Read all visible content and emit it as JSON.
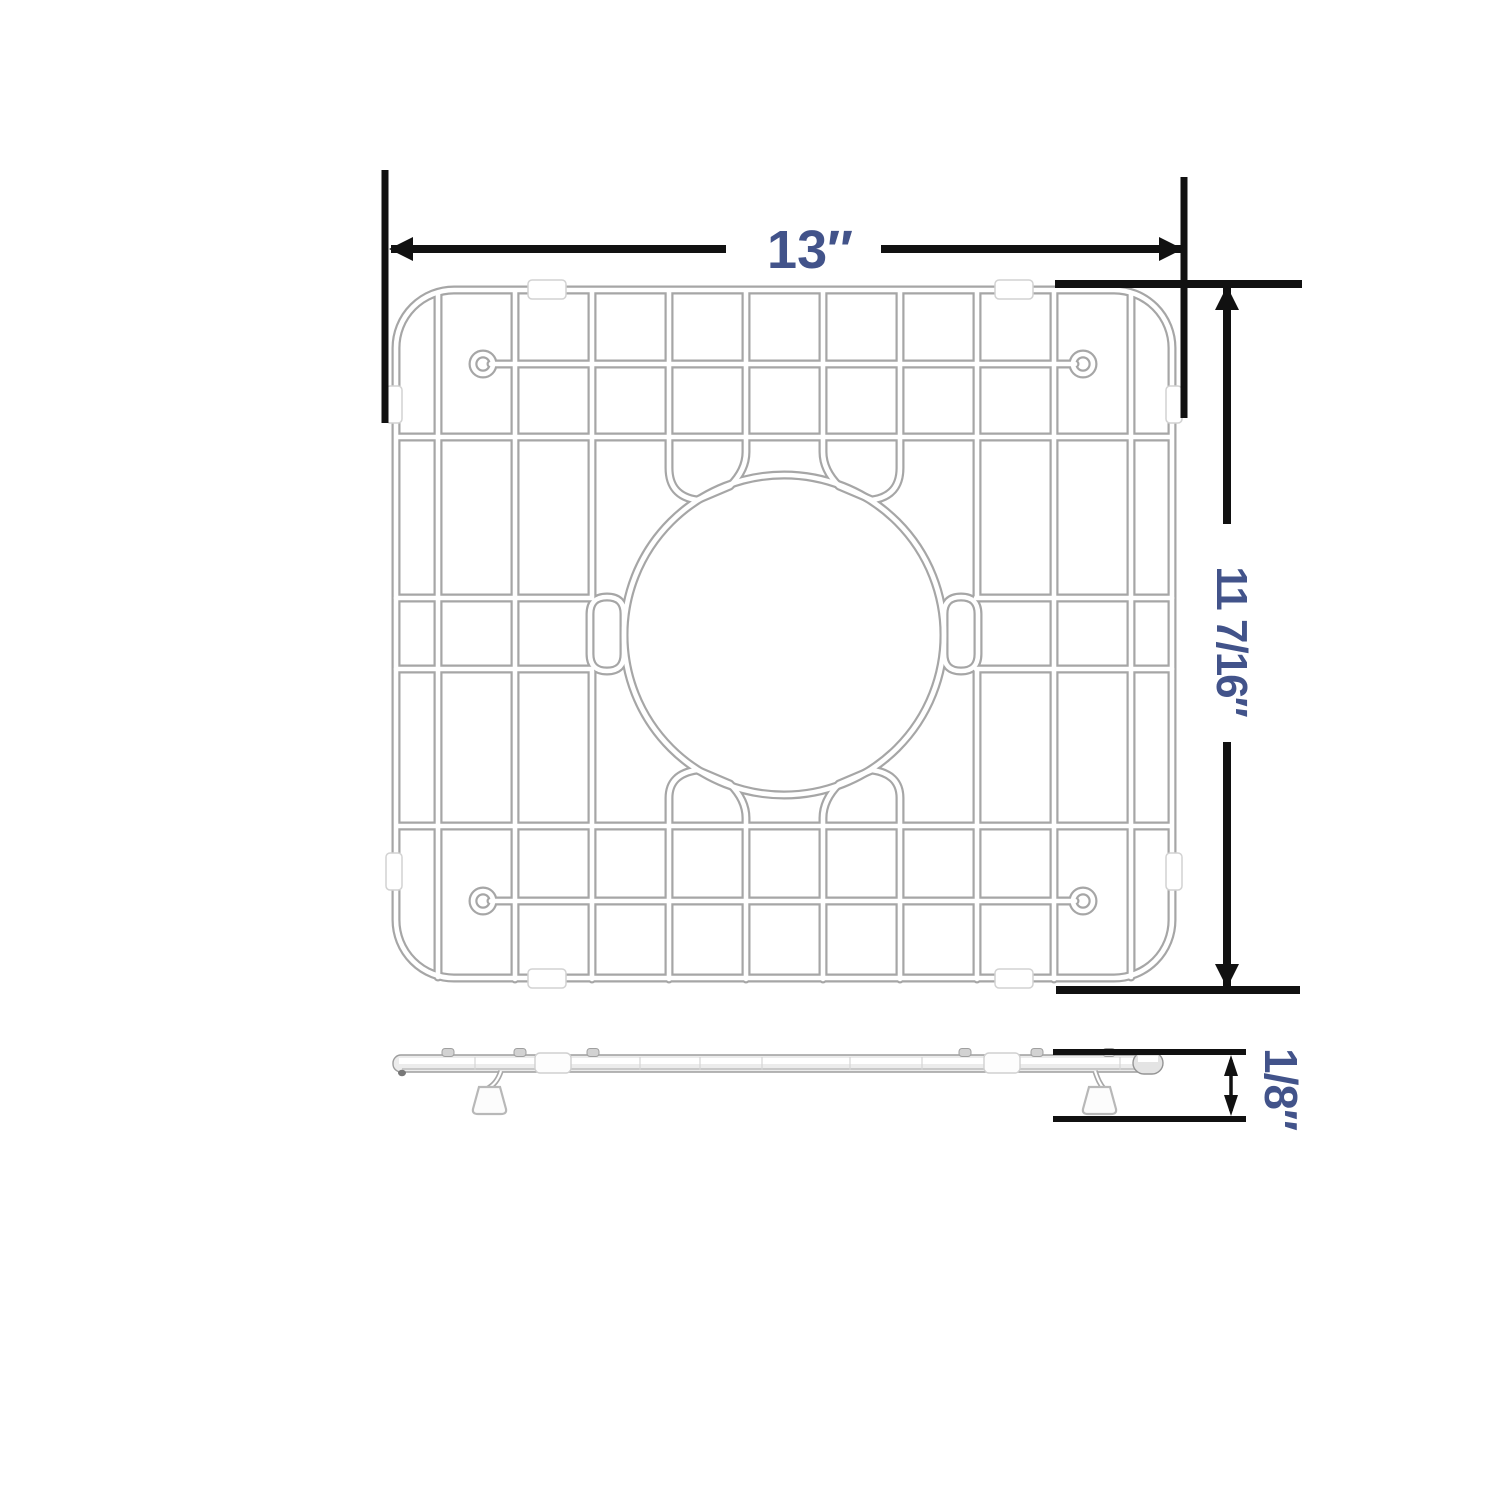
{
  "diagram": {
    "type": "product-dimension-diagram",
    "subject": "sink-bottom-grid",
    "dimensions": {
      "width": "13″",
      "height": "11 7/16″",
      "thickness": "1/8″"
    },
    "views": {
      "top_view": "grid top view with center drain opening",
      "side_view": "grid side profile with support feet"
    },
    "colors": {
      "background": "#ffffff",
      "dimension_line": "#111111",
      "label_text": "#42538a",
      "wire_shade": "#a6a6a6",
      "wire_highlight": "#ffffff",
      "clip_fill": "#ffffff"
    }
  }
}
